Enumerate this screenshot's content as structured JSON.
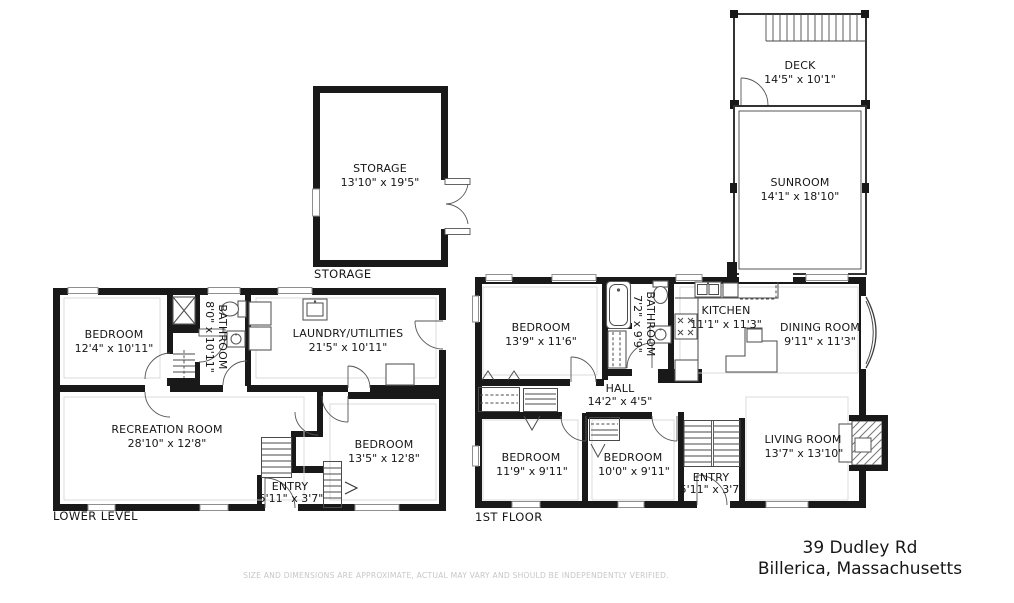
{
  "meta": {
    "address_line1": "39 Dudley Rd",
    "address_line2": "Billerica, Massachusetts",
    "disclaimer": "SIZE AND DIMENSIONS ARE APPROXIMATE, ACTUAL MAY VARY AND SHOULD BE INDEPENDENTLY VERIFIED.",
    "wall_color": "#191919",
    "background_color": "#ffffff"
  },
  "floor_labels": {
    "storage": "STORAGE",
    "lower_level": "LOWER LEVEL",
    "first_floor": "1ST FLOOR"
  },
  "rooms": {
    "storage": {
      "name": "STORAGE",
      "dims": "13'10\" x 19'5\""
    },
    "deck": {
      "name": "DECK",
      "dims": "14'5\" x 10'1\""
    },
    "sunroom": {
      "name": "SUNROOM",
      "dims": "14'1\" x 18'10\""
    },
    "ll_bedroom_left": {
      "name": "BEDROOM",
      "dims": "12'4\" x 10'11\""
    },
    "ll_bathroom": {
      "name": "BATHROOM",
      "dims": "8'0\" x 10'11\""
    },
    "ll_laundry": {
      "name": "LAUNDRY/UTILITIES",
      "dims": "21'5\" x 10'11\""
    },
    "ll_recreation": {
      "name": "RECREATION ROOM",
      "dims": "28'10\" x 12'8\""
    },
    "ll_bedroom_right": {
      "name": "BEDROOM",
      "dims": "13'5\" x 12'8\""
    },
    "ll_entry": {
      "name": "ENTRY",
      "dims": "5'11\" x 3'7\""
    },
    "ff_bedroom_top": {
      "name": "BEDROOM",
      "dims": "13'9\" x 11'6\""
    },
    "ff_bathroom": {
      "name": "BATHROOM",
      "dims": "7'2\" x 9'9\""
    },
    "ff_kitchen": {
      "name": "KITCHEN",
      "dims": "11'1\" x 11'3\""
    },
    "ff_dining": {
      "name": "DINING ROOM",
      "dims": "9'11\" x 11'3\""
    },
    "ff_hall": {
      "name": "HALL",
      "dims": "14'2\" x 4'5\""
    },
    "ff_bedroom_left": {
      "name": "BEDROOM",
      "dims": "11'9\" x 9'11\""
    },
    "ff_bedroom_mid": {
      "name": "BEDROOM",
      "dims": "10'0\" x 9'11\""
    },
    "ff_entry": {
      "name": "ENTRY",
      "dims": "5'11\" x 3'7\""
    },
    "ff_living": {
      "name": "LIVING ROOM",
      "dims": "13'7\" x 13'10\""
    }
  }
}
